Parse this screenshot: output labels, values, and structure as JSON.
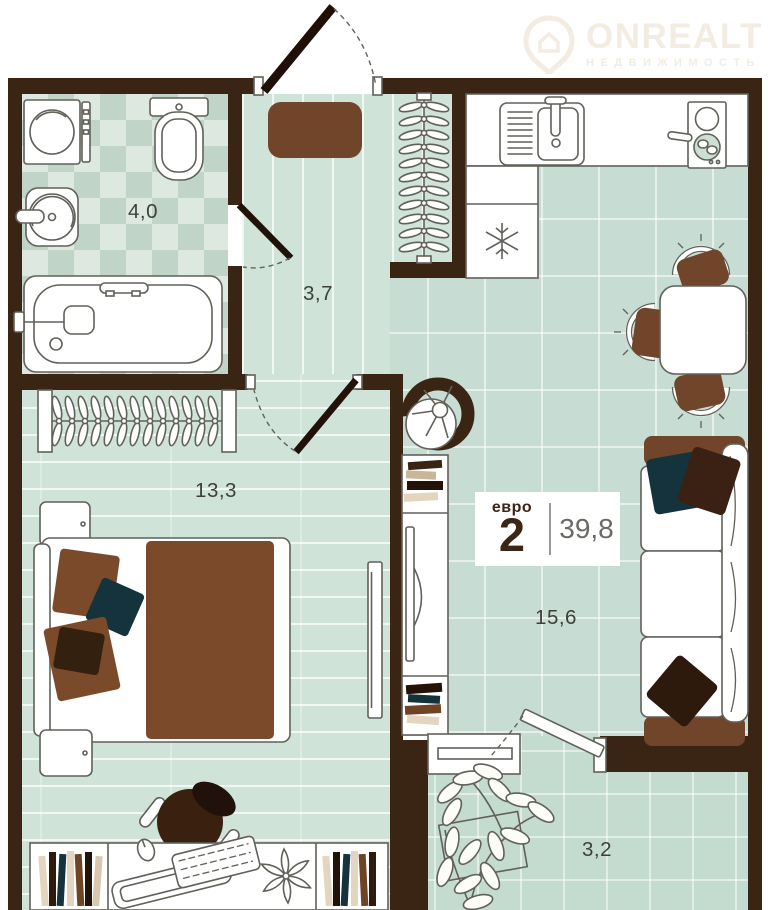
{
  "header": {
    "brand": "ONREALT",
    "tagline": "НЕДВИЖИМОСТЬ"
  },
  "badge": {
    "type_label": "евро",
    "type_number": "2",
    "total_area": "39,8"
  },
  "rooms": {
    "bathroom": "4,0",
    "hallway": "3,7",
    "bedroom": "13,3",
    "living_kitchen": "15,6",
    "balcony": "3,2"
  },
  "colors": {
    "wall": "#3a2414",
    "floor_tile": "#c7dcd2",
    "furniture_brown": "#70452a",
    "blanket_brown": "#7a4a2b",
    "pillow_teal": "#14333c",
    "pillow_dark_brown": "#3a2113",
    "outline": "#61615a",
    "logo_watermark": "#f3ece2"
  }
}
